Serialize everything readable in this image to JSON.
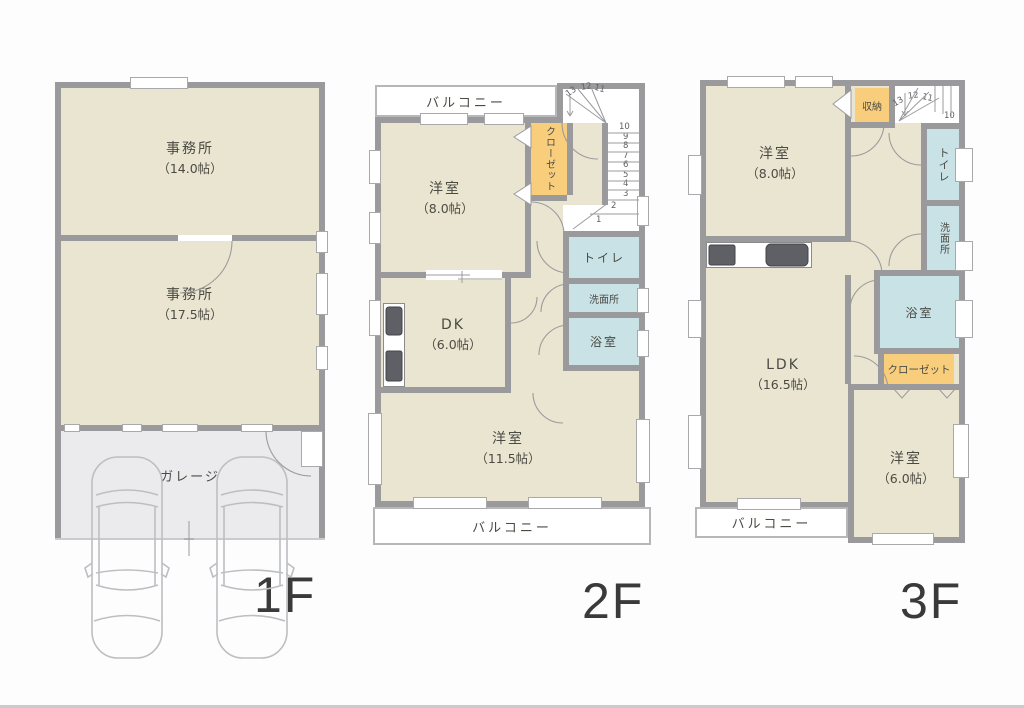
{
  "colors": {
    "wall": "#9a9a9c",
    "room": "#eae5d1",
    "wet": "#c9e2e6",
    "closet": "#f8ce7c",
    "garage": "#ebebed",
    "line": "#9b9b9d",
    "car": "#bcbec2",
    "text": "#4b4b44"
  },
  "floor1": {
    "label": "1F",
    "office_upper": {
      "name": "事務所",
      "size": "（14.0帖）"
    },
    "office_lower": {
      "name": "事務所",
      "size": "（17.5帖）"
    },
    "garage": {
      "name": "ガレージ"
    }
  },
  "floor2": {
    "label": "2F",
    "balcony_top": {
      "name": "バルコニー"
    },
    "balcony_bottom": {
      "name": "バルコニー"
    },
    "bedroom_8": {
      "name": "洋室",
      "size": "（8.0帖）"
    },
    "closet": {
      "name": "クローゼット"
    },
    "toilet": {
      "name": "トイレ"
    },
    "washroom": {
      "name": "洗面所"
    },
    "bath": {
      "name": "浴室"
    },
    "dk": {
      "name": "DK",
      "size": "（6.0帖）"
    },
    "bedroom_11": {
      "name": "洋室",
      "size": "（11.5帖）"
    },
    "stairs": {
      "steps": [
        "1",
        "2",
        "3",
        "4",
        "5",
        "6",
        "7",
        "8",
        "9",
        "10",
        "11",
        "12",
        "13"
      ]
    }
  },
  "floor3": {
    "label": "3F",
    "balcony": {
      "name": "バルコニー"
    },
    "bedroom_8": {
      "name": "洋室",
      "size": "（8.0帖）"
    },
    "storage": {
      "name": "収納"
    },
    "toilet": {
      "name": "トイレ"
    },
    "washroom": {
      "name": "洗面所"
    },
    "bath": {
      "name": "浴室"
    },
    "closet": {
      "name": "クローゼット"
    },
    "ldk": {
      "name": "LDK",
      "size": "（16.5帖）"
    },
    "bedroom_6": {
      "name": "洋室",
      "size": "（6.0帖）"
    },
    "stairs": {
      "steps": [
        "10",
        "11",
        "12",
        "13"
      ]
    }
  }
}
